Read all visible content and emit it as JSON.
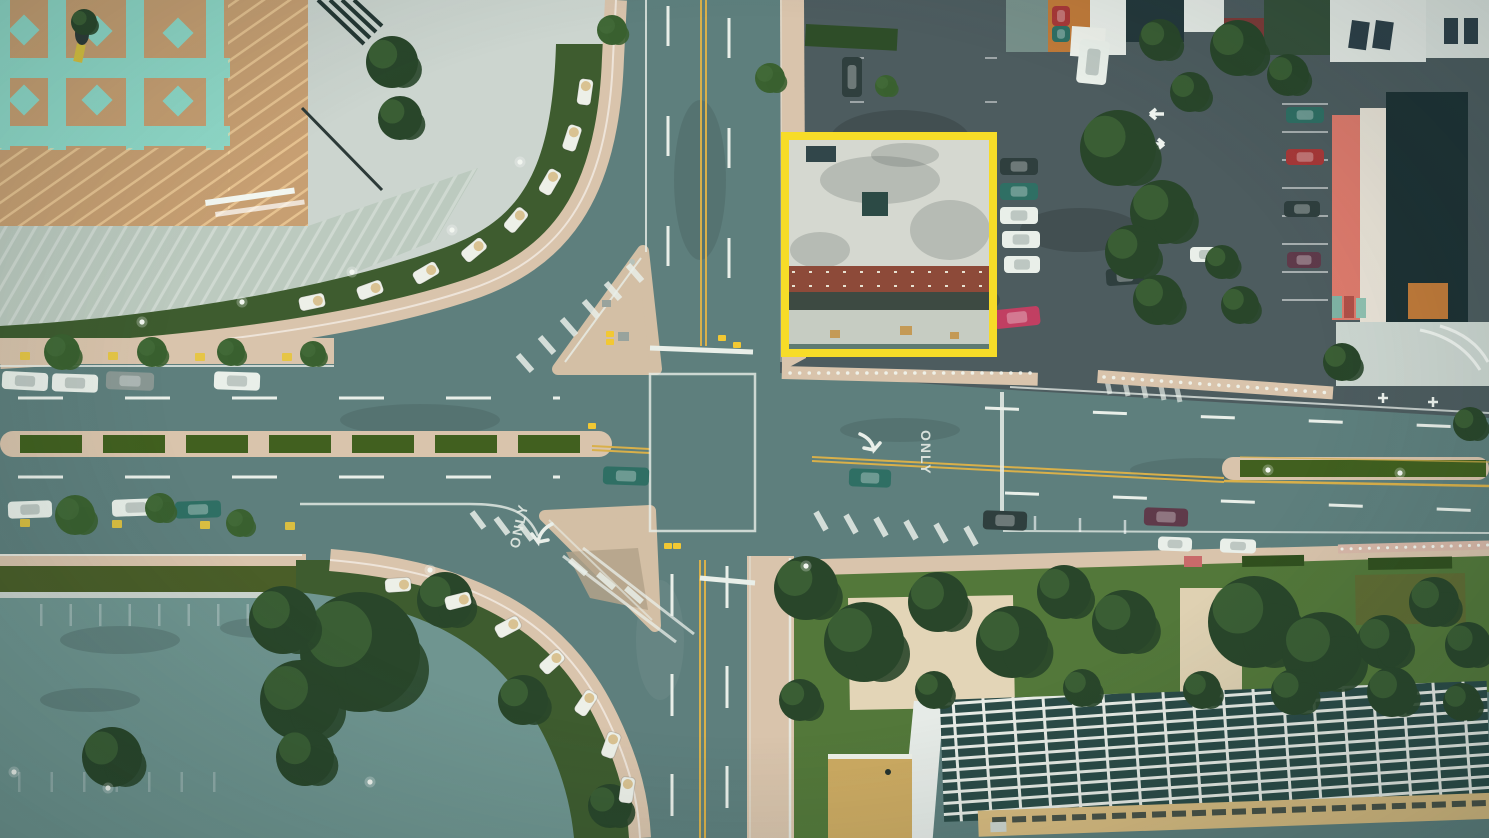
{
  "road_markings": {
    "only_label": "ONLY"
  },
  "annotation": {
    "label": "highlighted-building",
    "x": 785,
    "y": 136,
    "width": 208,
    "height": 217,
    "stroke_width": 8,
    "color": "#f7dc28"
  },
  "palette": {
    "road": "#5e7f7d",
    "roadDark": "#4d5c5f",
    "lotTeal": "#6f9590",
    "sidewalkTan": "#d9c4ac",
    "islandTan": "#d3bfa5",
    "deckTan": "#c79f72",
    "deckTeal": "#8fd9c8",
    "concretePale": "#ccd5cf",
    "roofPale": "#bccabf",
    "lawnGreen": "#3e5c2f",
    "lawnBright": "#53783a",
    "olive": "#5f6c33",
    "hedgeOlive": "#4a5e28",
    "hedgeGreen": "#41601f",
    "treeDark": "#29462a",
    "treeMid": "#3a6130",
    "marking": "#e9efe9",
    "yellowLine": "#d9b04a",
    "highlight": "#f7dc28",
    "brick": "#8d4a39",
    "whiteRoof": "#d5d8d0",
    "darkRoof": "#1d3134",
    "salmon": "#dd7a6c",
    "orangeWall": "#c07a39",
    "skylight": "#2b4b47",
    "courtTan": "#d9bc80",
    "carWhite": "#e9efe9",
    "carGray": "#8a9894",
    "carTeal": "#2f6f64",
    "carDark": "#2f3f3e",
    "carPink": "#c13f62",
    "carMaroon": "#5f3a4a",
    "carRed": "#a83838"
  },
  "cars": [
    [
      2,
      372,
      46,
      18,
      3,
      "carWhite"
    ],
    [
      52,
      374,
      46,
      18,
      2,
      "carWhite"
    ],
    [
      106,
      372,
      48,
      18,
      2,
      "carGray"
    ],
    [
      214,
      372,
      46,
      18,
      2,
      "carWhite"
    ],
    [
      8,
      501,
      44,
      17,
      -2,
      "carWhite"
    ],
    [
      112,
      499,
      48,
      17,
      -2,
      "carWhite"
    ],
    [
      175,
      501,
      46,
      17,
      -2,
      "carTeal"
    ],
    [
      603,
      467,
      46,
      18,
      2,
      "carTeal"
    ],
    [
      849,
      469,
      42,
      18,
      2,
      "carTeal"
    ],
    [
      983,
      511,
      44,
      19,
      2,
      "carDark"
    ],
    [
      1144,
      508,
      44,
      18,
      2,
      "carMaroon"
    ],
    [
      1158,
      537,
      34,
      14,
      2,
      "carWhite"
    ],
    [
      1220,
      539,
      36,
      14,
      2,
      "carWhite"
    ],
    [
      842,
      57,
      20,
      40,
      0,
      "carDark"
    ],
    [
      1000,
      158,
      38,
      17,
      0,
      "carDark"
    ],
    [
      1000,
      183,
      38,
      17,
      0,
      "carTeal"
    ],
    [
      1000,
      207,
      38,
      17,
      0,
      "carWhite"
    ],
    [
      1002,
      231,
      38,
      17,
      0,
      "carWhite"
    ],
    [
      1004,
      256,
      36,
      17,
      0,
      "carWhite"
    ],
    [
      994,
      308,
      46,
      19,
      -6,
      "carPink"
    ],
    [
      1286,
      107,
      38,
      16,
      0,
      "carTeal"
    ],
    [
      1286,
      149,
      38,
      16,
      0,
      "carRed"
    ],
    [
      1284,
      201,
      36,
      16,
      0,
      "carDark"
    ],
    [
      1287,
      252,
      34,
      16,
      0,
      "carMaroon"
    ],
    [
      1106,
      268,
      38,
      17,
      -4,
      "carDark"
    ],
    [
      1190,
      247,
      32,
      15,
      0,
      "carWhite"
    ],
    [
      1052,
      6,
      18,
      20,
      0,
      "carRed"
    ],
    [
      1052,
      26,
      18,
      16,
      0,
      "carTeal"
    ],
    [
      1078,
      40,
      30,
      44,
      6,
      "carWhite"
    ]
  ],
  "trees": [
    [
      392,
      62,
      26,
      "d"
    ],
    [
      400,
      118,
      22,
      "d"
    ],
    [
      84,
      22,
      13,
      "d"
    ],
    [
      62,
      352,
      18,
      "m"
    ],
    [
      152,
      352,
      15,
      "m"
    ],
    [
      231,
      352,
      14,
      "m"
    ],
    [
      313,
      354,
      13,
      "m"
    ],
    [
      75,
      515,
      20,
      "m"
    ],
    [
      160,
      508,
      15,
      "m"
    ],
    [
      240,
      523,
      14,
      "m"
    ],
    [
      360,
      652,
      60,
      "d"
    ],
    [
      300,
      700,
      40,
      "d"
    ],
    [
      283,
      620,
      34,
      "d"
    ],
    [
      112,
      757,
      30,
      "d"
    ],
    [
      305,
      757,
      29,
      "d"
    ],
    [
      523,
      700,
      25,
      "d"
    ],
    [
      610,
      806,
      22,
      "d"
    ],
    [
      445,
      600,
      28,
      "d"
    ],
    [
      612,
      30,
      15,
      "m"
    ],
    [
      770,
      78,
      15,
      "m"
    ],
    [
      886,
      86,
      11,
      "m"
    ],
    [
      1118,
      148,
      38,
      "d"
    ],
    [
      1162,
      212,
      32,
      "d"
    ],
    [
      1132,
      252,
      27,
      "d"
    ],
    [
      1158,
      300,
      25,
      "d"
    ],
    [
      1190,
      92,
      20,
      "d"
    ],
    [
      1222,
      262,
      17,
      "d"
    ],
    [
      1240,
      305,
      19,
      "d"
    ],
    [
      1288,
      75,
      21,
      "d"
    ],
    [
      1160,
      40,
      21,
      "d"
    ],
    [
      1238,
      48,
      28,
      "d"
    ],
    [
      1342,
      362,
      19,
      "d"
    ],
    [
      1470,
      424,
      17,
      "d"
    ],
    [
      806,
      588,
      32,
      "d"
    ],
    [
      864,
      642,
      40,
      "d"
    ],
    [
      938,
      602,
      30,
      "d"
    ],
    [
      1012,
      642,
      36,
      "d"
    ],
    [
      1064,
      592,
      27,
      "d"
    ],
    [
      1124,
      622,
      32,
      "d"
    ],
    [
      1254,
      622,
      46,
      "d"
    ],
    [
      1322,
      652,
      40,
      "d"
    ],
    [
      1384,
      642,
      27,
      "d"
    ],
    [
      1434,
      602,
      25,
      "d"
    ],
    [
      1468,
      645,
      23,
      "d"
    ],
    [
      934,
      690,
      19,
      "d"
    ],
    [
      1082,
      688,
      19,
      "d"
    ],
    [
      1202,
      690,
      19,
      "d"
    ],
    [
      1294,
      692,
      23,
      "d"
    ],
    [
      1392,
      692,
      25,
      "d"
    ],
    [
      1462,
      702,
      19,
      "d"
    ],
    [
      800,
      700,
      21,
      "d"
    ]
  ],
  "canopies": [
    [
      585,
      92,
      -82
    ],
    [
      572,
      138,
      -72
    ],
    [
      550,
      182,
      -60
    ],
    [
      516,
      220,
      -50
    ],
    [
      474,
      250,
      -40
    ],
    [
      426,
      273,
      -30
    ],
    [
      370,
      290,
      -20
    ],
    [
      312,
      302,
      -12
    ],
    [
      398,
      585,
      -4
    ],
    [
      458,
      601,
      -14
    ],
    [
      508,
      627,
      -28
    ],
    [
      552,
      662,
      -42
    ],
    [
      586,
      703,
      -56
    ],
    [
      611,
      745,
      -70
    ],
    [
      627,
      790,
      -82
    ]
  ],
  "light_poles": [
    [
      520,
      162
    ],
    [
      452,
      230
    ],
    [
      352,
      272
    ],
    [
      242,
      302
    ],
    [
      142,
      322
    ],
    [
      14,
      772
    ],
    [
      108,
      788
    ],
    [
      370,
      782
    ],
    [
      1268,
      470
    ],
    [
      1400,
      473
    ],
    [
      430,
      570
    ],
    [
      806,
      566
    ]
  ],
  "signals": [
    [
      610,
      334
    ],
    [
      610,
      342
    ],
    [
      592,
      426
    ],
    [
      722,
      338
    ],
    [
      737,
      345
    ],
    [
      668,
      546
    ],
    [
      677,
      546
    ]
  ],
  "curb_markers": [
    [
      25,
      356
    ],
    [
      113,
      356
    ],
    [
      200,
      357
    ],
    [
      287,
      357
    ],
    [
      25,
      523
    ],
    [
      117,
      524
    ],
    [
      205,
      525
    ],
    [
      290,
      526
    ]
  ]
}
